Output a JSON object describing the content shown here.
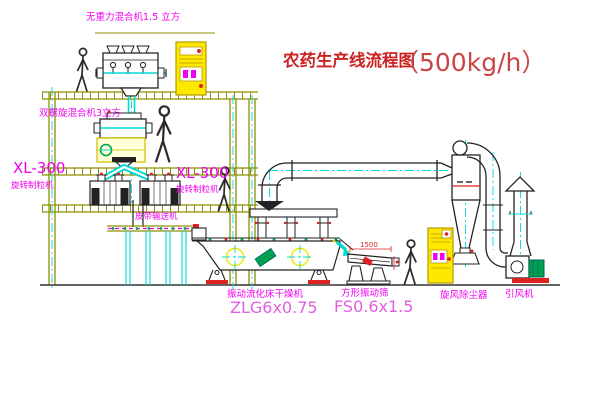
{
  "diagram": {
    "type": "process-flow-cad-drawing",
    "labels": {
      "title": "农药生产线流程图",
      "capacity": "（500kg/h）",
      "gravity_mixer": "无重力混合机1.5 立方",
      "spiral_mixer": "双螺旋混合机3立方",
      "granulator_model_left": "XL-300",
      "granulator_name_left": "旋转制粒机",
      "granulator_model_mid": "XL-300",
      "granulator_name_mid": "旋转制粒机",
      "belt_conveyor": "皮带输送机",
      "dryer_name": "振动流化床干燥机",
      "dryer_model": "ZLG6x0.75",
      "screen_name": "方形振动筛",
      "screen_model": "FS0.6x1.5",
      "cyclone": "旋风除尘器",
      "fan": "引风机",
      "screen_dim": "1500"
    },
    "colors": {
      "label_magenta": "#f000f0",
      "model_magenta": "#e060e0",
      "title_red": "#cc2222",
      "centerline_cyan": "#00d8d8",
      "structure_olive": "#8f8f00",
      "cabinet_yellow": "#ffe800",
      "motor_green": "#00a050",
      "machine_dark": "#222222",
      "accent_red": "#dd2222"
    }
  }
}
